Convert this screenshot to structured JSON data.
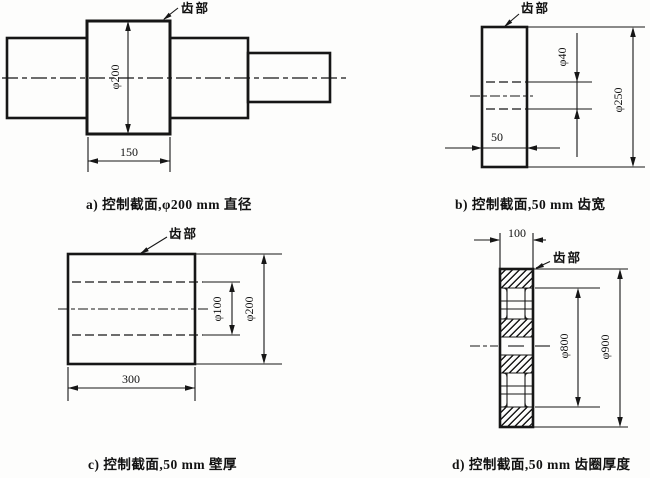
{
  "colors": {
    "ink": "#161616",
    "paper": "#fdfdfc"
  },
  "figures": {
    "a": {
      "caption": "a) 控制截面,φ200 mm 直径",
      "gear_label": "齿部",
      "dims": {
        "gear_diameter": "φ200",
        "gear_width": "150"
      }
    },
    "b": {
      "caption": "b) 控制截面,50 mm 齿宽",
      "gear_label": "齿部",
      "dims": {
        "outer_diameter": "φ250",
        "bore_diameter": "φ40",
        "face_width": "50"
      }
    },
    "c": {
      "caption": "c) 控制截面,50 mm 壁厚",
      "gear_label": "齿部",
      "dims": {
        "outer_diameter": "φ200",
        "bore_diameter": "φ100",
        "length": "300"
      }
    },
    "d": {
      "caption": "d) 控制截面,50 mm 齿圈厚度",
      "gear_label": "齿部",
      "dims": {
        "hub_width": "100",
        "rim_inner_diameter": "φ800",
        "outer_diameter": "φ900"
      }
    }
  }
}
